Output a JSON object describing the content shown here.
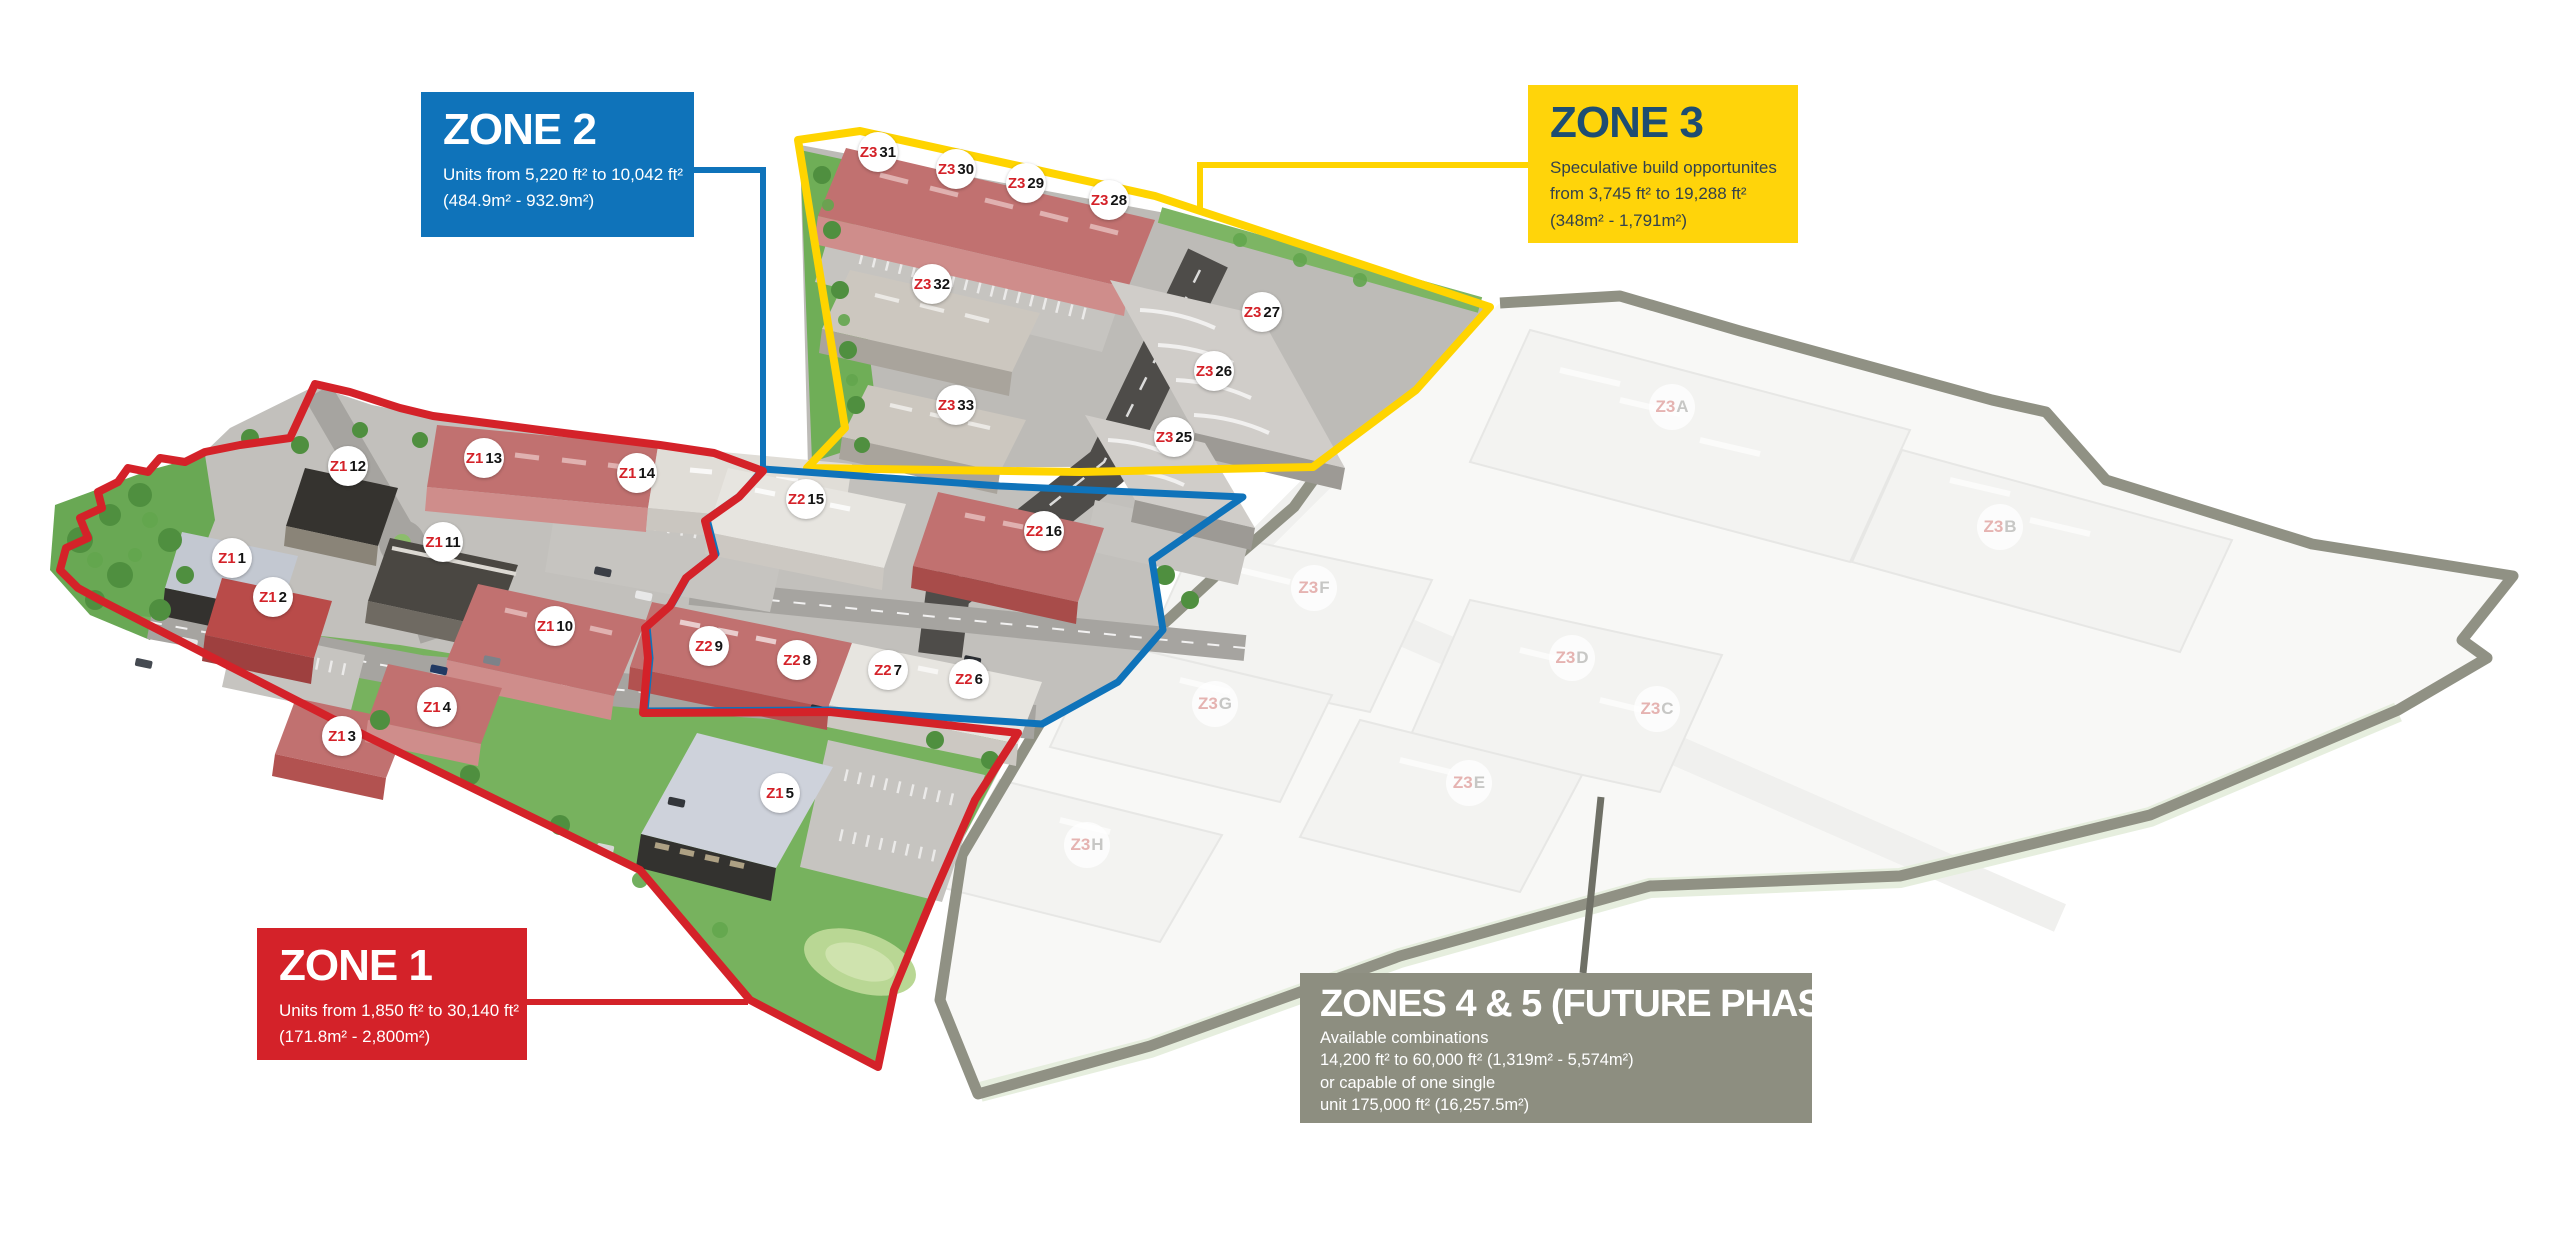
{
  "map": {
    "boxes": {
      "zone2": {
        "title": "ZONE 2",
        "lines": [
          "Units from 5,220 ft² to 10,042 ft²",
          "(484.9m²  - 932.9m²)"
        ],
        "color": "#0f73ba"
      },
      "zone3": {
        "title": "ZONE 3",
        "lines": [
          "Speculative build opportunites",
          "from 3,745 ft² to 19,288 ft²",
          "(348m²  - 1,791m²)"
        ],
        "color": "#ffd40a"
      },
      "zone1": {
        "title": "ZONE 1",
        "lines": [
          "Units from 1,850 ft² to 30,140 ft²",
          "(171.8m²  - 2,800m²)"
        ],
        "color": "#d42229"
      },
      "zones45": {
        "title": "ZONES 4 & 5 (FUTURE PHASE)",
        "lines": [
          "Available combinations",
          "14,200 ft² to 60,000 ft² (1,319m²  - 5,574m²)",
          "or capable of one single",
          "unit 175,000 ft² (16,257.5m²)"
        ],
        "color": "#8d8e80"
      }
    },
    "boundary_colors": {
      "zone1": "#d42229",
      "zone2": "#0f73ba",
      "zone3": "#ffd400",
      "future": "#909184"
    },
    "markers": [
      {
        "prefix": "Z1",
        "num": "1",
        "x": 232,
        "y": 558,
        "faded": false
      },
      {
        "prefix": "Z1",
        "num": "2",
        "x": 273,
        "y": 597,
        "faded": false
      },
      {
        "prefix": "Z1",
        "num": "3",
        "x": 342,
        "y": 736,
        "faded": false
      },
      {
        "prefix": "Z1",
        "num": "4",
        "x": 437,
        "y": 707,
        "faded": false
      },
      {
        "prefix": "Z1",
        "num": "5",
        "x": 780,
        "y": 793,
        "faded": false
      },
      {
        "prefix": "Z1",
        "num": "10",
        "x": 555,
        "y": 626,
        "faded": false
      },
      {
        "prefix": "Z1",
        "num": "11",
        "x": 443,
        "y": 542,
        "faded": false
      },
      {
        "prefix": "Z1",
        "num": "12",
        "x": 348,
        "y": 466,
        "faded": false
      },
      {
        "prefix": "Z1",
        "num": "13",
        "x": 484,
        "y": 458,
        "faded": false
      },
      {
        "prefix": "Z1",
        "num": "14",
        "x": 637,
        "y": 473,
        "faded": false
      },
      {
        "prefix": "Z2",
        "num": "6",
        "x": 969,
        "y": 679,
        "faded": false
      },
      {
        "prefix": "Z2",
        "num": "7",
        "x": 888,
        "y": 670,
        "faded": false
      },
      {
        "prefix": "Z2",
        "num": "8",
        "x": 797,
        "y": 660,
        "faded": false
      },
      {
        "prefix": "Z2",
        "num": "9",
        "x": 709,
        "y": 646,
        "faded": false
      },
      {
        "prefix": "Z2",
        "num": "15",
        "x": 806,
        "y": 499,
        "faded": false
      },
      {
        "prefix": "Z2",
        "num": "16",
        "x": 1044,
        "y": 531,
        "faded": false
      },
      {
        "prefix": "Z3",
        "num": "25",
        "x": 1174,
        "y": 437,
        "faded": false
      },
      {
        "prefix": "Z3",
        "num": "26",
        "x": 1214,
        "y": 371,
        "faded": false
      },
      {
        "prefix": "Z3",
        "num": "27",
        "x": 1262,
        "y": 312,
        "faded": false
      },
      {
        "prefix": "Z3",
        "num": "28",
        "x": 1109,
        "y": 200,
        "faded": false
      },
      {
        "prefix": "Z3",
        "num": "29",
        "x": 1026,
        "y": 183,
        "faded": false
      },
      {
        "prefix": "Z3",
        "num": "30",
        "x": 956,
        "y": 169,
        "faded": false
      },
      {
        "prefix": "Z3",
        "num": "31",
        "x": 878,
        "y": 152,
        "faded": false
      },
      {
        "prefix": "Z3",
        "num": "32",
        "x": 932,
        "y": 284,
        "faded": false
      },
      {
        "prefix": "Z3",
        "num": "33",
        "x": 956,
        "y": 405,
        "faded": false
      },
      {
        "prefix": "Z3",
        "num": "A",
        "x": 1672,
        "y": 407,
        "faded": true
      },
      {
        "prefix": "Z3",
        "num": "B",
        "x": 2000,
        "y": 527,
        "faded": true
      },
      {
        "prefix": "Z3",
        "num": "C",
        "x": 1657,
        "y": 709,
        "faded": true
      },
      {
        "prefix": "Z3",
        "num": "D",
        "x": 1572,
        "y": 658,
        "faded": true
      },
      {
        "prefix": "Z3",
        "num": "E",
        "x": 1469,
        "y": 783,
        "faded": true
      },
      {
        "prefix": "Z3",
        "num": "F",
        "x": 1314,
        "y": 588,
        "faded": true
      },
      {
        "prefix": "Z3",
        "num": "G",
        "x": 1215,
        "y": 704,
        "faded": true
      },
      {
        "prefix": "Z3",
        "num": "H",
        "x": 1087,
        "y": 845,
        "faded": true
      }
    ]
  }
}
